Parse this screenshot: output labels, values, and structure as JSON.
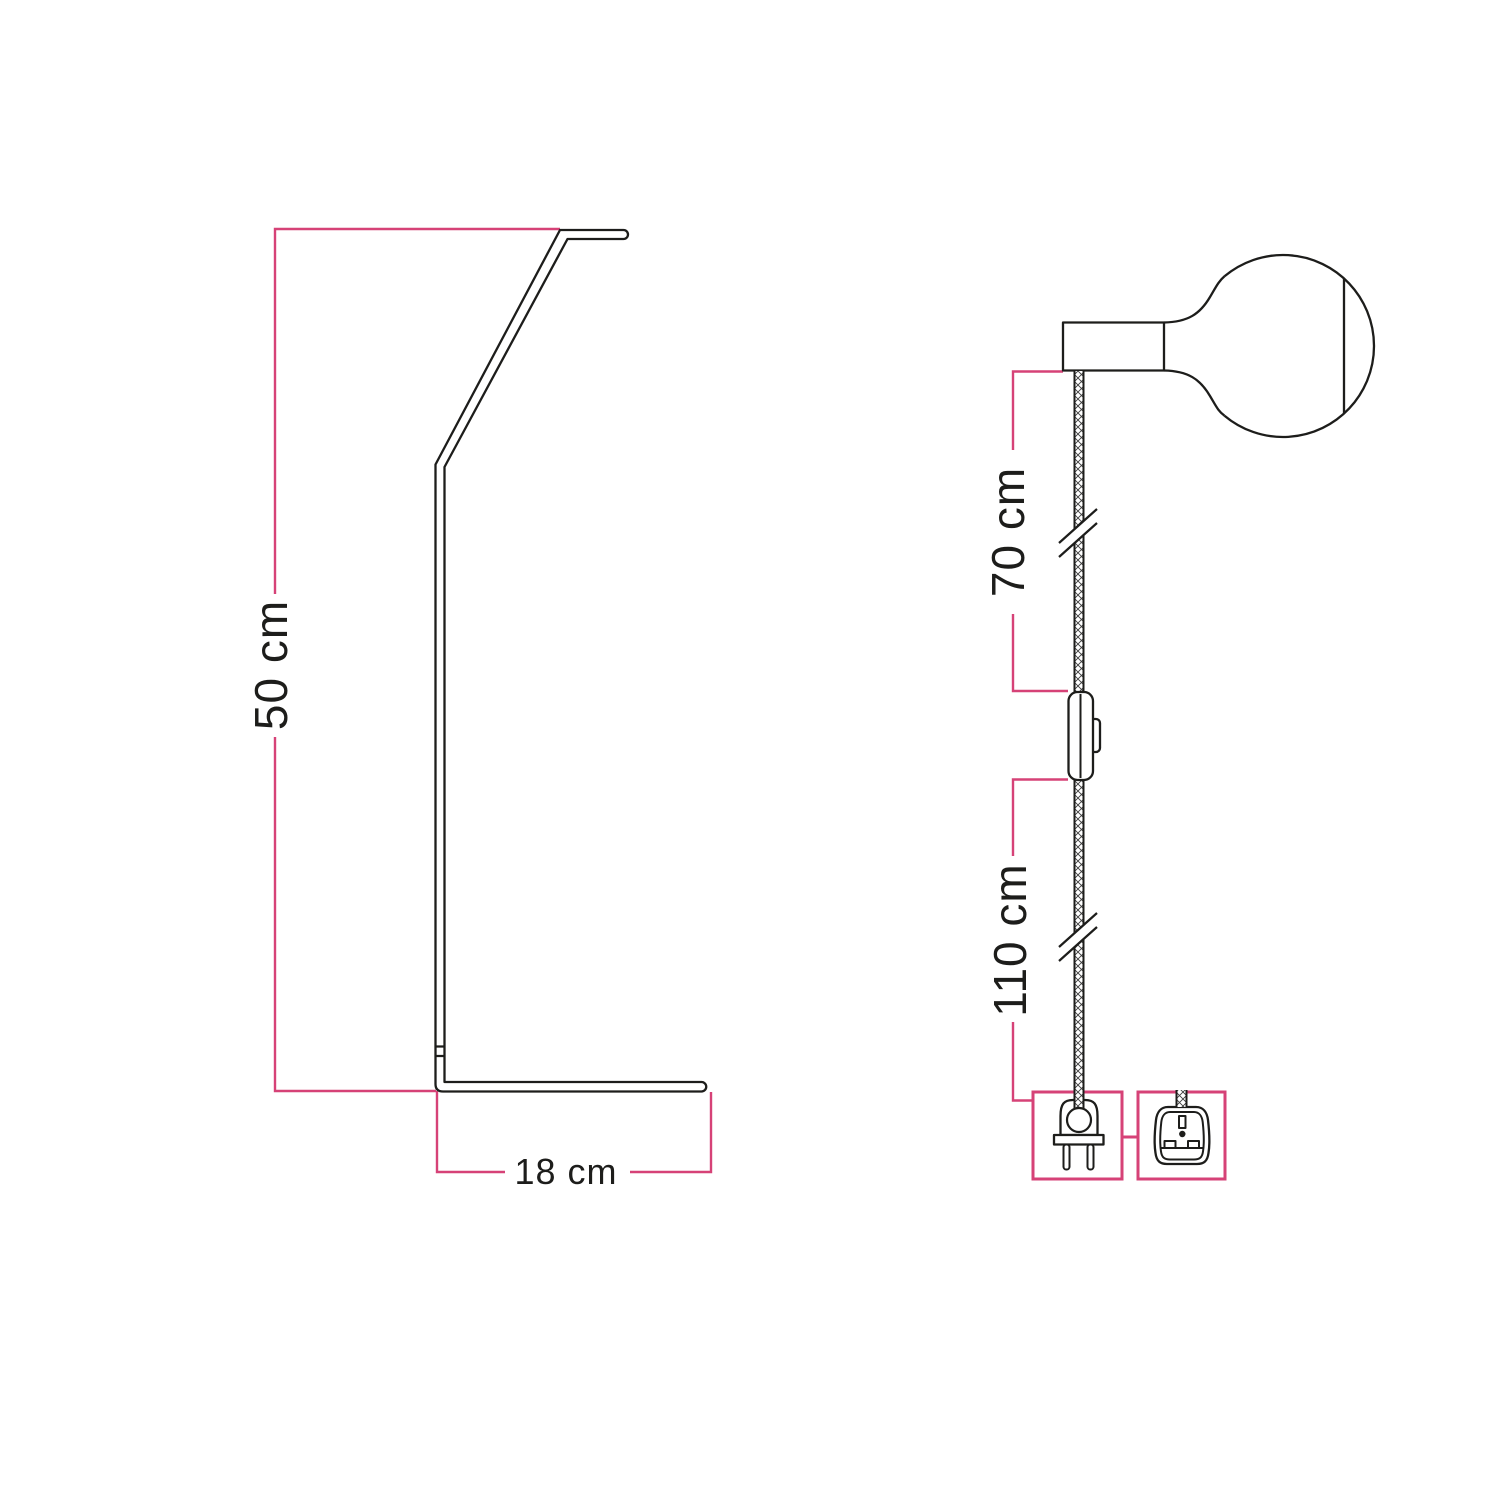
{
  "colors": {
    "background": "#ffffff",
    "line": "#1d1d1b",
    "text": "#1d1d1b",
    "dimension": "#d64277",
    "cable_hatch": "#3c3c3c"
  },
  "figures": {
    "stand": {
      "name": "table-lamp-stand-side-profile",
      "dims": {
        "height": {
          "label": "50 cm"
        },
        "base": {
          "label": "18 cm"
        }
      }
    },
    "pendant": {
      "name": "plug-in-pendant-cable-with-bulb",
      "dims": {
        "upper": {
          "label": "70 cm"
        },
        "lower": {
          "label": "110 cm"
        }
      },
      "icons": {
        "holder": "lamp-holder",
        "bulb": "globe-bulb",
        "cable": "braided-cable",
        "switch": "inline-switch",
        "plug_eu": "eu-two-pin-plug",
        "plug_uk": "uk-three-pin-plug"
      }
    }
  }
}
